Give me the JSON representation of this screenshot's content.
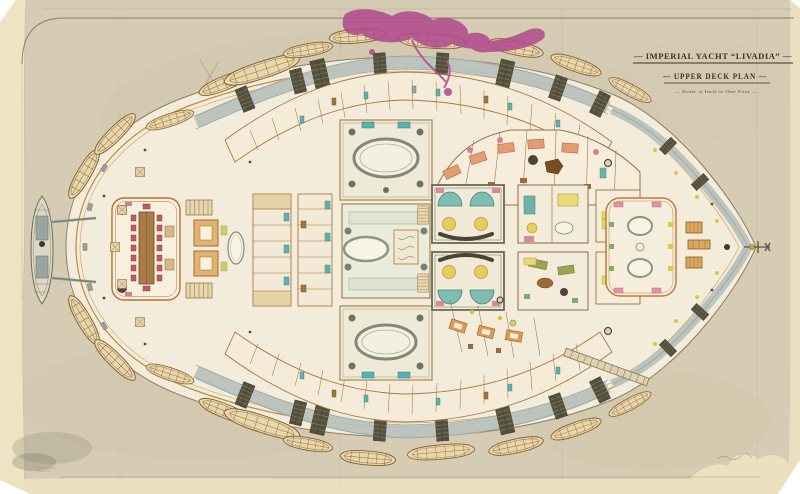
{
  "document": {
    "title": "— IMPERIAL YACHT “LIVADIA” —",
    "subtitle": "— UPPER DECK PLAN —",
    "scale_note": "— Scale ¼ Inch to One Foot —"
  },
  "artifacts": {
    "ink_mark": "magenta ink blot hand annotation, top centre",
    "ink_mark_color": "#b0488d",
    "corner_smudge": "dark smudge, bottom-left corner of sheet"
  },
  "palette": {
    "paper": "#d6ccb4",
    "paper_edge": "#eee3c2",
    "deck_interior": "#f3ecda",
    "deck_edge_line": "#c08a3e",
    "superstructure_band": "#b9c2bc",
    "grating": "#55513c",
    "lifeboat_fill": "#e9d7ab",
    "ink": "#3a3226"
  },
  "plan_features": {
    "lifeboats_port_side": 11,
    "lifeboats_starboard_side": 11,
    "steam_launch_astern": 1,
    "centre_skylight_rooms": 3,
    "bow_direction": "right"
  }
}
